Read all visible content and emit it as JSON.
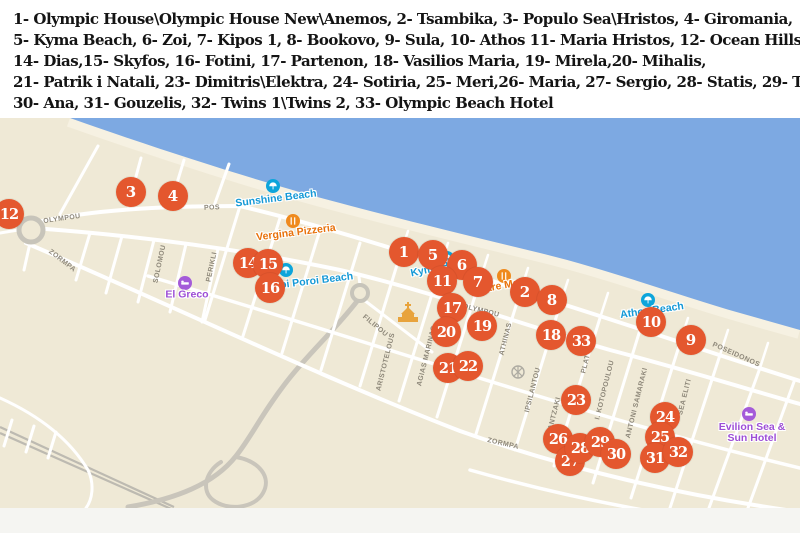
{
  "legend": {
    "lines": [
      "1- Olympic House\\Olympic House New\\Anemos, 2- Tsambika, 3- Populo Sea\\Hristos, 4- Giromania,",
      "5- Kyma Beach, 6- Zoi, 7- Kipos 1, 8- Bookovo, 9- Sula, 10- Athos 11- Maria Hristos, 12- Ocean Hills,",
      "14- Dias,15- Skyfos, 16- Fotini, 17- Partenon, 18- Vasilios Maria, 19- Mirela,20- Mihalis,",
      "21- Patrik i Natali, 23- Dimitris\\Elektra, 24- Sotiria, 25- Meri,26- Maria, 27- Sergio, 28- Statis, 29- Tuli,",
      "30- Ana, 31- Gouzelis, 32- Twins 1\\Twins 2, 33- Olympic Beach Hotel"
    ]
  },
  "map": {
    "colors": {
      "sea": "#7DA9E2",
      "sand": "#EFE9D6",
      "shore_band": "#F6F1E2",
      "road_white": "#FFFFFF",
      "road_gray": "#C9C5BB",
      "rail": "#BDBAB1",
      "marker": "#E4572E",
      "marker_text": "#FFFFFF",
      "street_label": "#8E887A",
      "beach_poi": "#1599D6",
      "beach_icon": "#0DA5DB",
      "restaurant_poi": "#E8710A",
      "restaurant_icon": "#EF8A1D",
      "lodging_poi": "#9D4ED6",
      "lodging_icon": "#A45BD9",
      "church_icon": "#E8A33C",
      "utility_icon": "#AEABA2"
    },
    "icons": {
      "beach": "beach-umbrella-circle-icon",
      "restaurant": "dining-circle-icon",
      "lodging": "bed-circle-icon",
      "church": "church-building-icon",
      "utility": "cross-circle-icon"
    },
    "pois": [
      {
        "type": "beach",
        "name": "Sunshine Beach",
        "ix": 273,
        "iy": 186,
        "lx": 276,
        "ly": 199,
        "rot": -7
      },
      {
        "type": "restaurant",
        "name": "Vergina Pizzeria",
        "ix": 293,
        "iy": 221,
        "lx": 296,
        "ly": 233,
        "rot": -7
      },
      {
        "type": "beach",
        "name": "Neoi Poroi Beach",
        "ix": 286,
        "iy": 270,
        "lx": 310,
        "ly": 282,
        "rot": -7
      },
      {
        "type": "beach",
        "name": "Kyma B",
        "ix": 447,
        "iy": 258,
        "lx": 430,
        "ly": 270,
        "rot": -12
      },
      {
        "type": "restaurant",
        "name": "Mare Ma",
        "ix": 504,
        "iy": 276,
        "lx": 498,
        "ly": 287,
        "rot": -10
      },
      {
        "type": "beach",
        "name": "Athos Beach",
        "ix": 648,
        "iy": 300,
        "lx": 652,
        "ly": 311,
        "rot": -8
      },
      {
        "type": "lodging",
        "name": "El Greco",
        "ix": 185,
        "iy": 283,
        "lx": 187,
        "ly": 295,
        "rot": 0
      },
      {
        "type": "lodging",
        "name": "Evilion Sea &\nSun Hotel",
        "ix": 749,
        "iy": 414,
        "lx": 752,
        "ly": 433,
        "rot": 0
      },
      {
        "type": "church",
        "name": "",
        "ix": 408,
        "iy": 313
      },
      {
        "type": "utility",
        "name": "",
        "ix": 518,
        "iy": 372
      }
    ],
    "street_labels": [
      {
        "t": "OLYMPOU",
        "x": 62,
        "y": 219,
        "r": -8
      },
      {
        "t": "ZORMPA",
        "x": 62,
        "y": 261,
        "r": 38
      },
      {
        "t": "POS",
        "x": 212,
        "y": 208,
        "r": -3
      },
      {
        "t": "SOLOMOU",
        "x": 160,
        "y": 264,
        "r": -78
      },
      {
        "t": "PERIKLI",
        "x": 212,
        "y": 267,
        "r": -78
      },
      {
        "t": "FILIPOU",
        "x": 375,
        "y": 326,
        "r": 40
      },
      {
        "t": "ARISTOTELOUS",
        "x": 386,
        "y": 362,
        "r": -76
      },
      {
        "t": "AGIAS MARINAS",
        "x": 427,
        "y": 356,
        "r": -76
      },
      {
        "t": "OLYMPOU",
        "x": 481,
        "y": 311,
        "r": 14
      },
      {
        "t": "ATHINAS",
        "x": 506,
        "y": 339,
        "r": -76
      },
      {
        "t": "IPSILANTOU",
        "x": 533,
        "y": 390,
        "r": -76
      },
      {
        "t": "KAZANTZAKI",
        "x": 553,
        "y": 421,
        "r": -76
      },
      {
        "t": "ZORMPA",
        "x": 503,
        "y": 444,
        "r": 13
      },
      {
        "t": "PLAT",
        "x": 586,
        "y": 364,
        "r": -76
      },
      {
        "t": "I. KOTOPOULOU",
        "x": 605,
        "y": 390,
        "r": -76
      },
      {
        "t": "ANTONI SAMARAKI",
        "x": 637,
        "y": 403,
        "r": -76
      },
      {
        "t": "SEA ELITI",
        "x": 685,
        "y": 397,
        "r": -76
      },
      {
        "t": "POSEIDONOS",
        "x": 736,
        "y": 355,
        "r": 24
      }
    ],
    "markers": [
      {
        "n": 1,
        "x": 404,
        "y": 252
      },
      {
        "n": 2,
        "x": 525,
        "y": 292
      },
      {
        "n": 3,
        "x": 131,
        "y": 192
      },
      {
        "n": 4,
        "x": 173,
        "y": 196
      },
      {
        "n": 5,
        "x": 433,
        "y": 255
      },
      {
        "n": 6,
        "x": 462,
        "y": 265
      },
      {
        "n": 7,
        "x": 478,
        "y": 282
      },
      {
        "n": 8,
        "x": 552,
        "y": 300
      },
      {
        "n": 9,
        "x": 691,
        "y": 340
      },
      {
        "n": 10,
        "x": 651,
        "y": 322
      },
      {
        "n": 11,
        "x": 442,
        "y": 281
      },
      {
        "n": 12,
        "x": 9,
        "y": 214
      },
      {
        "n": 14,
        "x": 248,
        "y": 263
      },
      {
        "n": 15,
        "x": 268,
        "y": 264
      },
      {
        "n": 16,
        "x": 270,
        "y": 288
      },
      {
        "n": 17,
        "x": 452,
        "y": 308
      },
      {
        "n": 18,
        "x": 551,
        "y": 335
      },
      {
        "n": 19,
        "x": 482,
        "y": 326
      },
      {
        "n": 20,
        "x": 446,
        "y": 332
      },
      {
        "n": 21,
        "x": 448,
        "y": 368
      },
      {
        "n": 22,
        "x": 468,
        "y": 366
      },
      {
        "n": 23,
        "x": 576,
        "y": 400
      },
      {
        "n": 24,
        "x": 665,
        "y": 417
      },
      {
        "n": 25,
        "x": 660,
        "y": 437
      },
      {
        "n": 26,
        "x": 558,
        "y": 439
      },
      {
        "n": 27,
        "x": 570,
        "y": 461
      },
      {
        "n": 28,
        "x": 580,
        "y": 448
      },
      {
        "n": 29,
        "x": 600,
        "y": 442
      },
      {
        "n": 30,
        "x": 616,
        "y": 454
      },
      {
        "n": 31,
        "x": 655,
        "y": 458
      },
      {
        "n": 32,
        "x": 678,
        "y": 452
      },
      {
        "n": 33,
        "x": 581,
        "y": 341
      }
    ]
  }
}
